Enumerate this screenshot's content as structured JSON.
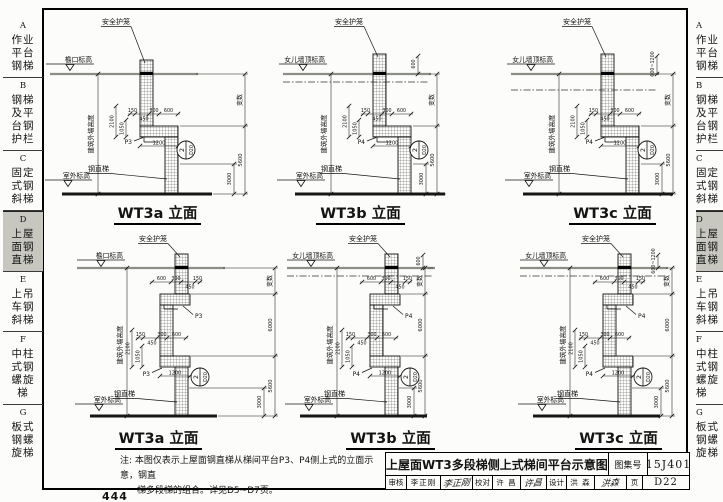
{
  "sidebar": {
    "items": [
      {
        "letter": "A",
        "lines": [
          "作业",
          "平台",
          "钢梯"
        ],
        "active": false
      },
      {
        "letter": "B",
        "lines": [
          "钢梯",
          "及平",
          "台钢",
          "护栏"
        ],
        "active": false
      },
      {
        "letter": "C",
        "lines": [
          "固定",
          "式钢",
          "斜梯"
        ],
        "active": false
      },
      {
        "letter": "D",
        "lines": [
          "上屋",
          "面钢",
          "直梯"
        ],
        "active": true
      },
      {
        "letter": "E",
        "lines": [
          "上吊",
          "车钢",
          "斜梯"
        ],
        "active": false
      },
      {
        "letter": "F",
        "lines": [
          "中柱",
          "式钢",
          "螺旋",
          "梯"
        ],
        "active": false
      },
      {
        "letter": "G",
        "lines": [
          "板式",
          "钢螺",
          "旋梯"
        ],
        "active": false
      }
    ]
  },
  "note": {
    "label": "注:",
    "lines": [
      "本图仅表示上屋面钢直梯从梯间平台P3、P4侧上式的立面示意，钢直",
      "梯多段梯的组合。详见D5~D7页。"
    ]
  },
  "titleblock": {
    "title": "上屋面WT3多段梯侧上式梯间平台示意图",
    "atlas_label": "图集号",
    "atlas_no": "15J401",
    "page_label": "页",
    "page_no": "D22",
    "reviewer_label": "审核",
    "reviewer": "李正刚",
    "reviewer_sig": "李正刚",
    "checker_label": "校对",
    "checker": "许 昌",
    "checker_sig": "许昌",
    "designer_label": "设计",
    "designer": "洪 森",
    "designer_sig": "洪森"
  },
  "page_footer_number": "444",
  "diagrams": [
    {
      "id": "top-a",
      "title": "WT3a 立面",
      "variant": "single",
      "roof": "eave",
      "labels": {
        "cage": "安全护笼",
        "top_elevation": "檐口标高",
        "bottom_elevation": "室外标高",
        "wall_height": "建筑外墙高度",
        "ladder": "钢直梯",
        "variable": "变数"
      },
      "platforms": [
        "P3"
      ],
      "dims": {
        "chain": [
          "150",
          "450",
          "300",
          "600"
        ],
        "upper_chain": null,
        "vertical": [
          "2100",
          "1050"
        ],
        "horizontal": "1200",
        "right": [
          "5600",
          "3000"
        ],
        "top_right": null
      },
      "detail": {
        "num": "2",
        "sheet": "D20"
      }
    },
    {
      "id": "top-b",
      "title": "WT3b 立面",
      "variant": "single",
      "roof": "parapet-low",
      "labels": {
        "cage": "安全护笼",
        "top_elevation": "女儿墙顶标高",
        "bottom_elevation": "室外标高",
        "wall_height": "建筑外墙高度",
        "ladder": "钢直梯",
        "variable": "变数"
      },
      "platforms": [
        "P4"
      ],
      "dims": {
        "chain": [
          "150",
          "450",
          "300",
          "600"
        ],
        "upper_chain": null,
        "vertical": [
          "2100",
          "1050"
        ],
        "horizontal": "1200",
        "right": [
          "5600",
          "3000"
        ],
        "top_right": "600"
      },
      "detail": {
        "num": "2",
        "sheet": "D20"
      }
    },
    {
      "id": "top-c",
      "title": "WT3c 立面",
      "variant": "single",
      "roof": "parapet-tall",
      "labels": {
        "cage": "安全护笼",
        "top_elevation": "女儿墙顶标高",
        "bottom_elevation": "室外标高",
        "wall_height": "建筑外墙高度",
        "ladder": "钢直梯",
        "variable": "变数"
      },
      "platforms": [
        "P4"
      ],
      "dims": {
        "chain": [
          "150",
          "450",
          "300",
          "600"
        ],
        "upper_chain": null,
        "vertical": [
          "2100",
          "1050"
        ],
        "horizontal": "1200",
        "right": [
          "5600",
          "3000"
        ],
        "top_right": "600~1200"
      },
      "detail": {
        "num": "2",
        "sheet": "D20"
      }
    },
    {
      "id": "bot-a",
      "title": "WT3a 立面",
      "variant": "double",
      "roof": "eave",
      "labels": {
        "cage": "安全护笼",
        "top_elevation": "檐口标高",
        "bottom_elevation": "室外标高",
        "wall_height": "建筑外墙高度",
        "ladder": "钢直梯",
        "variable": "变数"
      },
      "platforms": [
        "P3",
        "P3"
      ],
      "dims": {
        "chain": [
          "150",
          "450",
          "300",
          "600"
        ],
        "upper_chain": [
          "600",
          "300",
          "450",
          "150"
        ],
        "vertical": [
          "2100",
          "1050"
        ],
        "horizontal": "1200",
        "right": [
          "6000",
          "5600",
          "3000"
        ],
        "top_right": null
      },
      "detail": {
        "num": "2",
        "sheet": "D20"
      }
    },
    {
      "id": "bot-b",
      "title": "WT3b 立面",
      "variant": "double",
      "roof": "parapet-low",
      "labels": {
        "cage": "安全护笼",
        "top_elevation": "女儿墙顶标高",
        "bottom_elevation": "室外标高",
        "wall_height": "建筑外墙高度",
        "ladder": "钢直梯",
        "variable": "变数"
      },
      "platforms": [
        "P4",
        "P4"
      ],
      "dims": {
        "chain": [
          "150",
          "450",
          "300",
          "600"
        ],
        "upper_chain": [
          "600",
          "300",
          "450",
          "150"
        ],
        "vertical": [
          "2100",
          "1050"
        ],
        "horizontal": "1200",
        "right": [
          "6000",
          "5600",
          "3000"
        ],
        "top_right": "600"
      },
      "detail": {
        "num": "2",
        "sheet": "D20"
      }
    },
    {
      "id": "bot-c",
      "title": "WT3c 立面",
      "variant": "double",
      "roof": "parapet-low",
      "labels": {
        "cage": "安全护笼",
        "top_elevation": "女儿墙顶标高",
        "bottom_elevation": "室外标高",
        "wall_height": "建筑外墙高度",
        "ladder": "钢直梯",
        "variable": "变数"
      },
      "platforms": [
        "P4",
        "P4"
      ],
      "dims": {
        "chain": [
          "150",
          "450",
          "300",
          "600"
        ],
        "upper_chain": [
          "600",
          "300",
          "450",
          "150"
        ],
        "vertical": [
          "2100",
          "1050"
        ],
        "horizontal": "1200",
        "right": [
          "6000",
          "5600",
          "3000"
        ],
        "top_right": "600~1200"
      },
      "detail": {
        "num": "2",
        "sheet": "D20"
      }
    }
  ]
}
